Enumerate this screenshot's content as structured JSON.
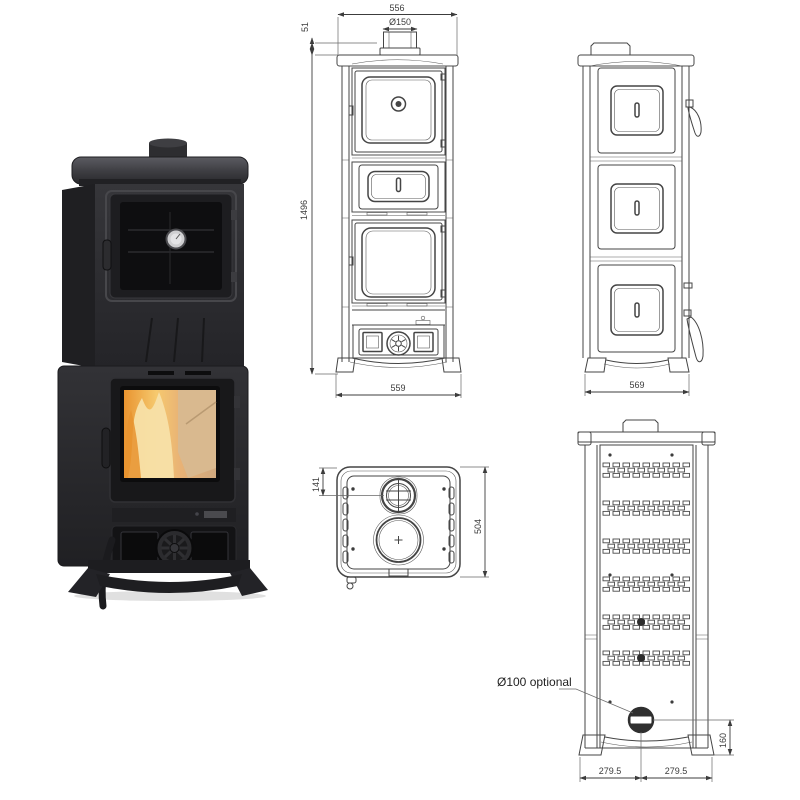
{
  "page": {
    "background": "#ffffff",
    "line_color": "#454545",
    "dim_text_color": "#3c3c3c"
  },
  "photo": {
    "subject": "black cast-iron wood burning stove with upper oven door, middle drawer band, lower fire chamber window and air-control rosette",
    "colors": {
      "body": "#2b2b2e",
      "body_dark": "#1c1c1e",
      "top_plate": "#54545a",
      "glass": "#0e0e10",
      "flame_bright": "#f7e0a8",
      "flame_mid": "#efa744",
      "flame_deep": "#d9822a",
      "wood": "#d9b98f",
      "thermometer_dial": "#e4e4e6"
    }
  },
  "front_view": {
    "dim_top_width": "556",
    "dim_flue_diameter": "Ø150",
    "dim_collar_height": "51",
    "dim_total_height": "1496",
    "dim_base_width": "559"
  },
  "side_view": {
    "dim_depth": "569"
  },
  "top_view": {
    "dim_flue_offset": "141",
    "dim_depth": "504"
  },
  "back_view": {
    "label_outlet": "Ø100 optional",
    "dim_outlet_height": "160",
    "dim_left_half": "279.5",
    "dim_right_half": "279.5",
    "vent_slot_groups": 6
  }
}
